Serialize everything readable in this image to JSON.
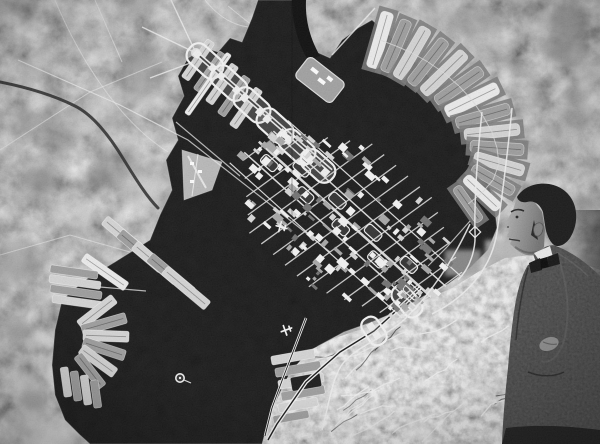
{
  "palette": {
    "land_base": "#8d8d8d",
    "land_bright": "#b9b9b9",
    "bay": "#060606",
    "structure_white": "#f2f2f2",
    "strip_bright": "#ececec",
    "strip_light": "#d4d4d4",
    "strip_mid": "#9b9b9b",
    "platform_gray": "#757575",
    "jacket": "#1d1d1d",
    "trousers": "#141414",
    "hair": "#121212",
    "face_light": "#b5b5b5",
    "face_dark": "#6f6f6f",
    "collar": "#e9e9e9",
    "bowtie": "#0d0d0d"
  },
  "model": {
    "strip_format": "x,y,rotationDeg,length,width,tone",
    "ne_pier_strips": [
      [
        380,
        40,
        -74,
        58,
        13,
        "b"
      ],
      [
        396,
        46,
        -67,
        56,
        12,
        "m"
      ],
      [
        412,
        53,
        -60,
        58,
        13,
        "l"
      ],
      [
        428,
        62,
        -52,
        56,
        12,
        "m"
      ],
      [
        444,
        73,
        -44,
        58,
        13,
        "l"
      ],
      [
        459,
        86,
        -35,
        56,
        12,
        "m"
      ],
      [
        472,
        100,
        -26,
        58,
        13,
        "b"
      ],
      [
        483,
        116,
        -16,
        56,
        12,
        "m"
      ],
      [
        492,
        132,
        -6,
        56,
        12,
        "l"
      ],
      [
        497,
        148,
        4,
        54,
        12,
        "m"
      ],
      [
        499,
        164,
        16,
        52,
        12,
        "l"
      ],
      [
        493,
        180,
        30,
        48,
        11,
        "m"
      ],
      [
        482,
        193,
        43,
        46,
        11,
        "b"
      ],
      [
        468,
        204,
        55,
        42,
        10,
        "m"
      ]
    ],
    "west_shore": {
      "row_east": [
        [
          74,
          272,
          8,
          48,
          8,
          "m"
        ],
        [
          75,
          282,
          8,
          52,
          8,
          "l"
        ],
        [
          76,
          292,
          8,
          52,
          8,
          "m"
        ],
        [
          77,
          302,
          8,
          50,
          8,
          "l"
        ]
      ],
      "fan": [
        [
          97,
          312,
          -38,
          44,
          11,
          "l"
        ],
        [
          104,
          324,
          -16,
          46,
          11,
          "m"
        ],
        [
          106,
          336,
          2,
          46,
          11,
          "l"
        ],
        [
          104,
          349,
          18,
          44,
          11,
          "m"
        ],
        [
          98,
          361,
          36,
          42,
          11,
          "l"
        ],
        [
          90,
          371,
          52,
          40,
          10,
          "m"
        ]
      ],
      "row_south": [
        [
          66,
          382,
          82,
          30,
          8,
          "l"
        ],
        [
          76,
          386,
          82,
          30,
          8,
          "m"
        ],
        [
          86,
          390,
          82,
          30,
          8,
          "l"
        ],
        [
          96,
          394,
          82,
          28,
          8,
          "m"
        ]
      ]
    },
    "port_bars_nw": [
      [
        198,
        60,
        -55,
        46,
        9,
        "l"
      ],
      [
        210,
        72,
        -55,
        46,
        9,
        "m"
      ],
      [
        222,
        84,
        -55,
        46,
        9,
        "l"
      ],
      [
        234,
        96,
        -55,
        46,
        9,
        "m"
      ],
      [
        246,
        108,
        -55,
        46,
        9,
        "l"
      ],
      [
        208,
        84,
        -55,
        74,
        6,
        "b"
      ]
    ],
    "port_bars_sw": [
      [
        126,
        238,
        40,
        56,
        11,
        "l"
      ],
      [
        141,
        251,
        40,
        56,
        11,
        "m"
      ],
      [
        156,
        263,
        40,
        56,
        11,
        "l"
      ],
      [
        171,
        275,
        40,
        56,
        11,
        "m"
      ],
      [
        186,
        288,
        40,
        56,
        11,
        "l"
      ],
      [
        105,
        272,
        35,
        52,
        10,
        "b"
      ]
    ],
    "se_stripes": [
      [
        293,
        357,
        -10,
        44,
        9,
        "l"
      ],
      [
        298,
        369,
        -10,
        46,
        9,
        "m"
      ],
      [
        301,
        381,
        -10,
        46,
        9,
        "l"
      ],
      [
        303,
        393,
        -10,
        44,
        9,
        "m"
      ],
      [
        298,
        405,
        -10,
        40,
        9,
        "l"
      ],
      [
        291,
        417,
        -10,
        36,
        8,
        "m"
      ],
      [
        306,
        382,
        -10,
        30,
        14,
        "d"
      ]
    ],
    "axis_loops": [
      [
        205,
        61,
        42,
        40,
        23
      ],
      [
        229,
        83,
        42,
        40,
        23
      ],
      [
        252,
        105,
        42,
        40,
        23
      ],
      [
        275,
        126,
        42,
        40,
        23
      ],
      [
        297,
        147,
        42,
        40,
        23
      ],
      [
        318,
        166,
        42,
        38,
        22
      ],
      [
        407,
        301,
        50,
        36,
        20
      ],
      [
        374,
        331,
        56,
        30,
        18
      ]
    ],
    "axis_rails_nw": "M 196,53 L 331,171",
    "axis_south": "M 421,287 L 407,301 L 374,331 L 340,352 L 306,382 L 277,424 L 268,440",
    "coast_rail_se": "M 306,318 L 293,352 L 283,378 L 272,408 L 265,436",
    "approach_lines": [
      "M 171,0 L 196,53",
      "M 142,27 L 196,53",
      "M 150,78 L 193,62",
      "M 332,55 L 375,8"
    ],
    "pier_module": [
      320,
      80,
      38,
      46,
      26
    ],
    "bay_links": [
      "M 18,60 L 120,105 L 188,140 L 262,198 L 330,252",
      "M 470,221 L 447,247 L 428,266",
      "M 176,122 L 240,176",
      "M 100,287 L 146,291"
    ],
    "west_roads": [
      "M 0,150 L 90,92 L 162,62",
      "M 55,0 C 80,60 120,122 168,152",
      "M 95,0 L 122,62",
      "M 0,255 L 70,235 L 130,252",
      "M 228,6 L 258,30",
      "M 205,0 C 224,24 248,32 268,24"
    ],
    "river": "M 0,82 C 30,88 55,96 75,106 C 95,116 112,140 124,160 C 134,176 146,196 158,208",
    "east_roads": [
      "M 512,108 C 508,150 503,190 497,232 C 494,252 486,268 474,282 C 462,296 448,306 432,314",
      "M 482,112 C 478,150 474,195 475,232 C 476,250 470,268 458,280",
      "M 470,224 C 452,262 432,292 406,318 C 384,338 362,344 346,360 C 333,372 330,400 322,430"
    ],
    "road_diamond": [
      475,
      232
    ],
    "grid": {
      "center": [
        348,
        222
      ],
      "u_angle": 42,
      "v_angle": -36,
      "u_min": -120,
      "u_max": 112,
      "long_offsets": [
        -36,
        -18,
        0,
        18,
        36
      ],
      "long_widths": [
        1.2,
        1.5,
        2.6,
        1.5,
        1.2
      ],
      "cross_step": 16,
      "cross_vmax": 76,
      "blocks": 165,
      "seed": 7,
      "module_step": 24
    },
    "markers": {
      "airplanes": [
        [
          281,
          227,
          15
        ],
        [
          286,
          330,
          -20
        ]
      ],
      "buoy": [
        180,
        378
      ]
    },
    "mottle_regions": [
      {
        "x": 0,
        "y": 0,
        "w": 235,
        "h": 235,
        "count": 26,
        "seed": 3,
        "rmin": 8,
        "rmax": 26,
        "tones": [
          "#6e6e6e",
          "#c9c9c9",
          "#7d7d7d",
          "#bfbfbf"
        ],
        "op": 0.38
      },
      {
        "x": 0,
        "y": 235,
        "w": 115,
        "h": 209,
        "count": 20,
        "seed": 5,
        "rmin": 10,
        "rmax": 28,
        "tones": [
          "#dcdcdc",
          "#e8e8e8",
          "#9c9c9c",
          "#cfcfcf"
        ],
        "op": 0.5
      },
      {
        "x": 432,
        "y": 0,
        "w": 168,
        "h": 230,
        "count": 24,
        "seed": 9,
        "rmin": 8,
        "rmax": 26,
        "tones": [
          "#6b6b6b",
          "#cbcbcb",
          "#858585",
          "#c2c2c2"
        ],
        "op": 0.4
      }
    ],
    "mottle_se": {
      "x": 300,
      "y": 335,
      "w": 300,
      "h": 109,
      "count": 16,
      "seed": 12,
      "rmin": 6,
      "rmax": 16,
      "tones": [
        "#e9e9e9",
        "#f4f4f4",
        "#d0d0d0"
      ],
      "op": 0.35
    },
    "farm_squares": [
      [
        445,
        250,
        36,
        26,
        "#9e9e9e"
      ],
      [
        485,
        240,
        40,
        30,
        "#b7b7b7"
      ],
      [
        530,
        248,
        38,
        28,
        "#8d8d8d"
      ],
      [
        568,
        258,
        32,
        40,
        "#a8a8a8"
      ],
      [
        455,
        285,
        34,
        26,
        "#b0b0b0"
      ],
      [
        498,
        278,
        36,
        30,
        "#878787"
      ],
      [
        540,
        288,
        40,
        30,
        "#b2b2b2"
      ],
      [
        576,
        300,
        24,
        36,
        "#909090"
      ]
    ],
    "ridges": {
      "seed": 21,
      "count": 30,
      "x": 302,
      "y": 330,
      "w": 298,
      "h": 112,
      "angle": -28
    },
    "haneda_runways": [
      "M 188,156 L 206,188",
      "M 198,154 L 192,196"
    ],
    "seam_x": 292
  }
}
